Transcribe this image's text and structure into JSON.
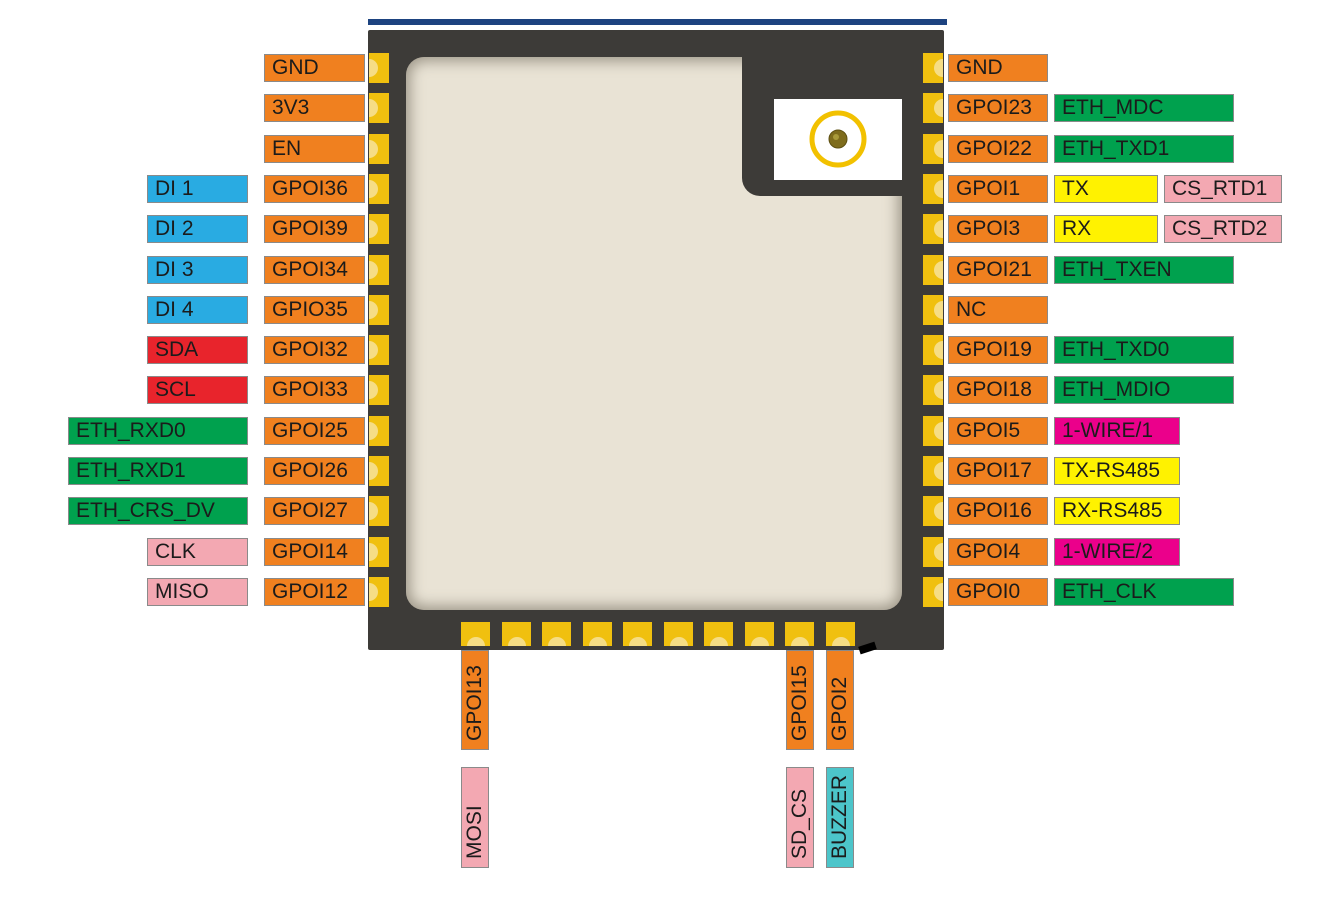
{
  "title": "ESP32 module pinout diagram",
  "colors": {
    "gpio_orange": "#F0801F",
    "digital_input_blue": "#29ABE2",
    "i2c_red": "#E8242C",
    "ethernet_green": "#00A14E",
    "spi_pink": "#F3A8B2",
    "uart_yellow": "#FFF200",
    "onewire_magenta": "#EB008B",
    "buzzer_teal": "#4CC5CA",
    "pad_gold": "#F0C00F",
    "pad_gold_light": "#F6DD85",
    "chip_body": "#3D3B38",
    "chip_inner": "#E9E3D5",
    "top_bar_blue": "#1D4380",
    "antenna_ring_gold": "#F2C100",
    "antenna_dot_olive": "#7E6C1C"
  },
  "left_pins": [
    {
      "gpio": "GND",
      "functions": []
    },
    {
      "gpio": "3V3",
      "functions": []
    },
    {
      "gpio": "EN",
      "functions": []
    },
    {
      "gpio": "GPOI36",
      "functions": [
        {
          "label": "DI 1",
          "color": "blue"
        }
      ]
    },
    {
      "gpio": "GPOI39",
      "functions": [
        {
          "label": "DI 2",
          "color": "blue"
        }
      ]
    },
    {
      "gpio": "GPOI34",
      "functions": [
        {
          "label": "DI 3",
          "color": "blue"
        }
      ]
    },
    {
      "gpio": "GPIO35",
      "functions": [
        {
          "label": "DI 4",
          "color": "blue"
        }
      ]
    },
    {
      "gpio": "GPOI32",
      "functions": [
        {
          "label": "SDA",
          "color": "red"
        }
      ]
    },
    {
      "gpio": "GPOI33",
      "functions": [
        {
          "label": "SCL",
          "color": "red"
        }
      ]
    },
    {
      "gpio": "GPOI25",
      "functions": [
        {
          "label": "ETH_RXD0",
          "color": "green"
        }
      ]
    },
    {
      "gpio": "GPOI26",
      "functions": [
        {
          "label": "ETH_RXD1",
          "color": "green"
        }
      ]
    },
    {
      "gpio": "GPOI27",
      "functions": [
        {
          "label": "ETH_CRS_DV",
          "color": "green"
        }
      ]
    },
    {
      "gpio": "GPOI14",
      "functions": [
        {
          "label": "CLK",
          "color": "pink"
        }
      ]
    },
    {
      "gpio": "GPOI12",
      "functions": [
        {
          "label": "MISO",
          "color": "pink"
        }
      ]
    }
  ],
  "right_pins": [
    {
      "gpio": "GND",
      "functions": []
    },
    {
      "gpio": "GPOI23",
      "functions": [
        {
          "label": "ETH_MDC",
          "color": "green"
        }
      ]
    },
    {
      "gpio": "GPOI22",
      "functions": [
        {
          "label": "ETH_TXD1",
          "color": "green"
        }
      ]
    },
    {
      "gpio": "GPOI1",
      "functions": [
        {
          "label": "TX",
          "color": "yellow"
        },
        {
          "label": "CS_RTD1",
          "color": "pink"
        }
      ]
    },
    {
      "gpio": "GPOI3",
      "functions": [
        {
          "label": "RX",
          "color": "yellow"
        },
        {
          "label": "CS_RTD2",
          "color": "pink"
        }
      ]
    },
    {
      "gpio": "GPOI21",
      "functions": [
        {
          "label": "ETH_TXEN",
          "color": "green"
        }
      ]
    },
    {
      "gpio": "NC",
      "functions": []
    },
    {
      "gpio": "GPOI19",
      "functions": [
        {
          "label": "ETH_TXD0",
          "color": "green"
        }
      ]
    },
    {
      "gpio": "GPOI18",
      "functions": [
        {
          "label": "ETH_MDIO",
          "color": "green"
        }
      ]
    },
    {
      "gpio": "GPOI5",
      "functions": [
        {
          "label": "1-WIRE/1",
          "color": "magenta"
        }
      ]
    },
    {
      "gpio": "GPOI17",
      "functions": [
        {
          "label": "TX-RS485",
          "color": "yellow"
        }
      ]
    },
    {
      "gpio": "GPOI16",
      "functions": [
        {
          "label": "RX-RS485",
          "color": "yellow"
        }
      ]
    },
    {
      "gpio": "GPOI4",
      "functions": [
        {
          "label": "1-WIRE/2",
          "color": "magenta"
        }
      ]
    },
    {
      "gpio": "GPOI0",
      "functions": [
        {
          "label": "ETH_CLK",
          "color": "green"
        }
      ]
    }
  ],
  "bottom_pins": [
    {
      "gpio": "GPOI13",
      "functions": [
        {
          "label": "MOSI",
          "color": "pink"
        }
      ]
    },
    {
      "gpio": "GPOI15",
      "functions": [
        {
          "label": "SD_CS",
          "color": "pink"
        }
      ]
    },
    {
      "gpio": "GPOI2",
      "functions": [
        {
          "label": "BUZZER",
          "color": "teal"
        }
      ]
    }
  ]
}
